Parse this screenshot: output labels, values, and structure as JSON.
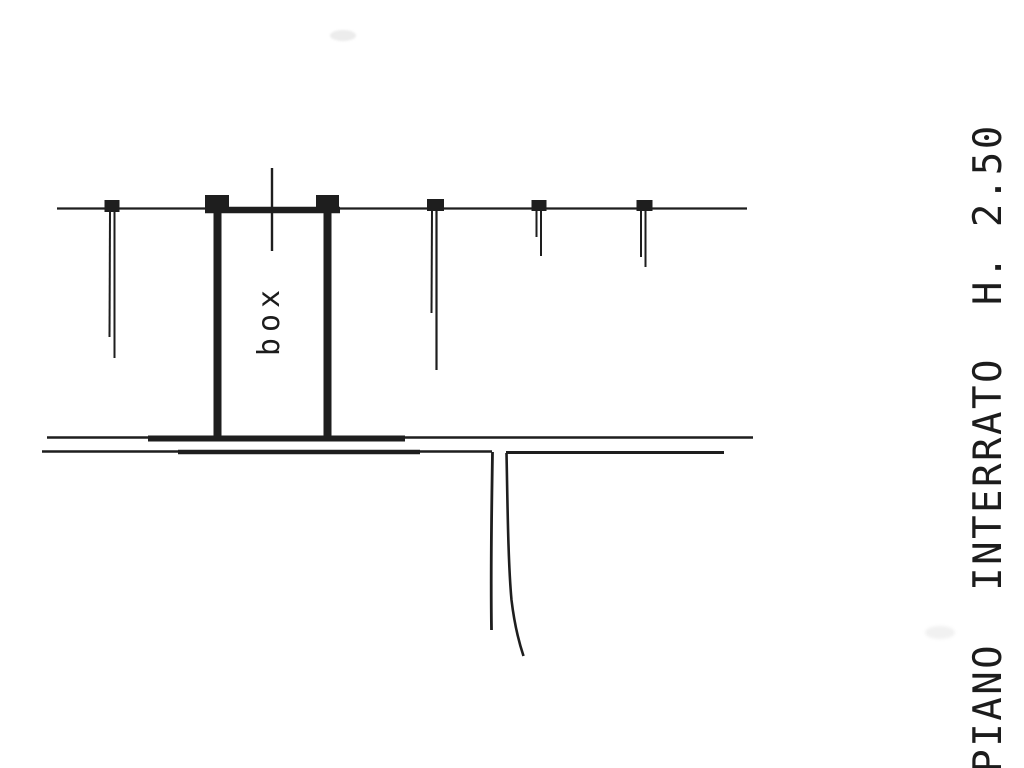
{
  "drawing": {
    "type": "scanned-floor-plan",
    "room_label": "box",
    "plan_title": "PIANO  INTERRATO  H. 2.50",
    "ink_color": "#1e1e1e",
    "background_color": "#ffffff"
  }
}
